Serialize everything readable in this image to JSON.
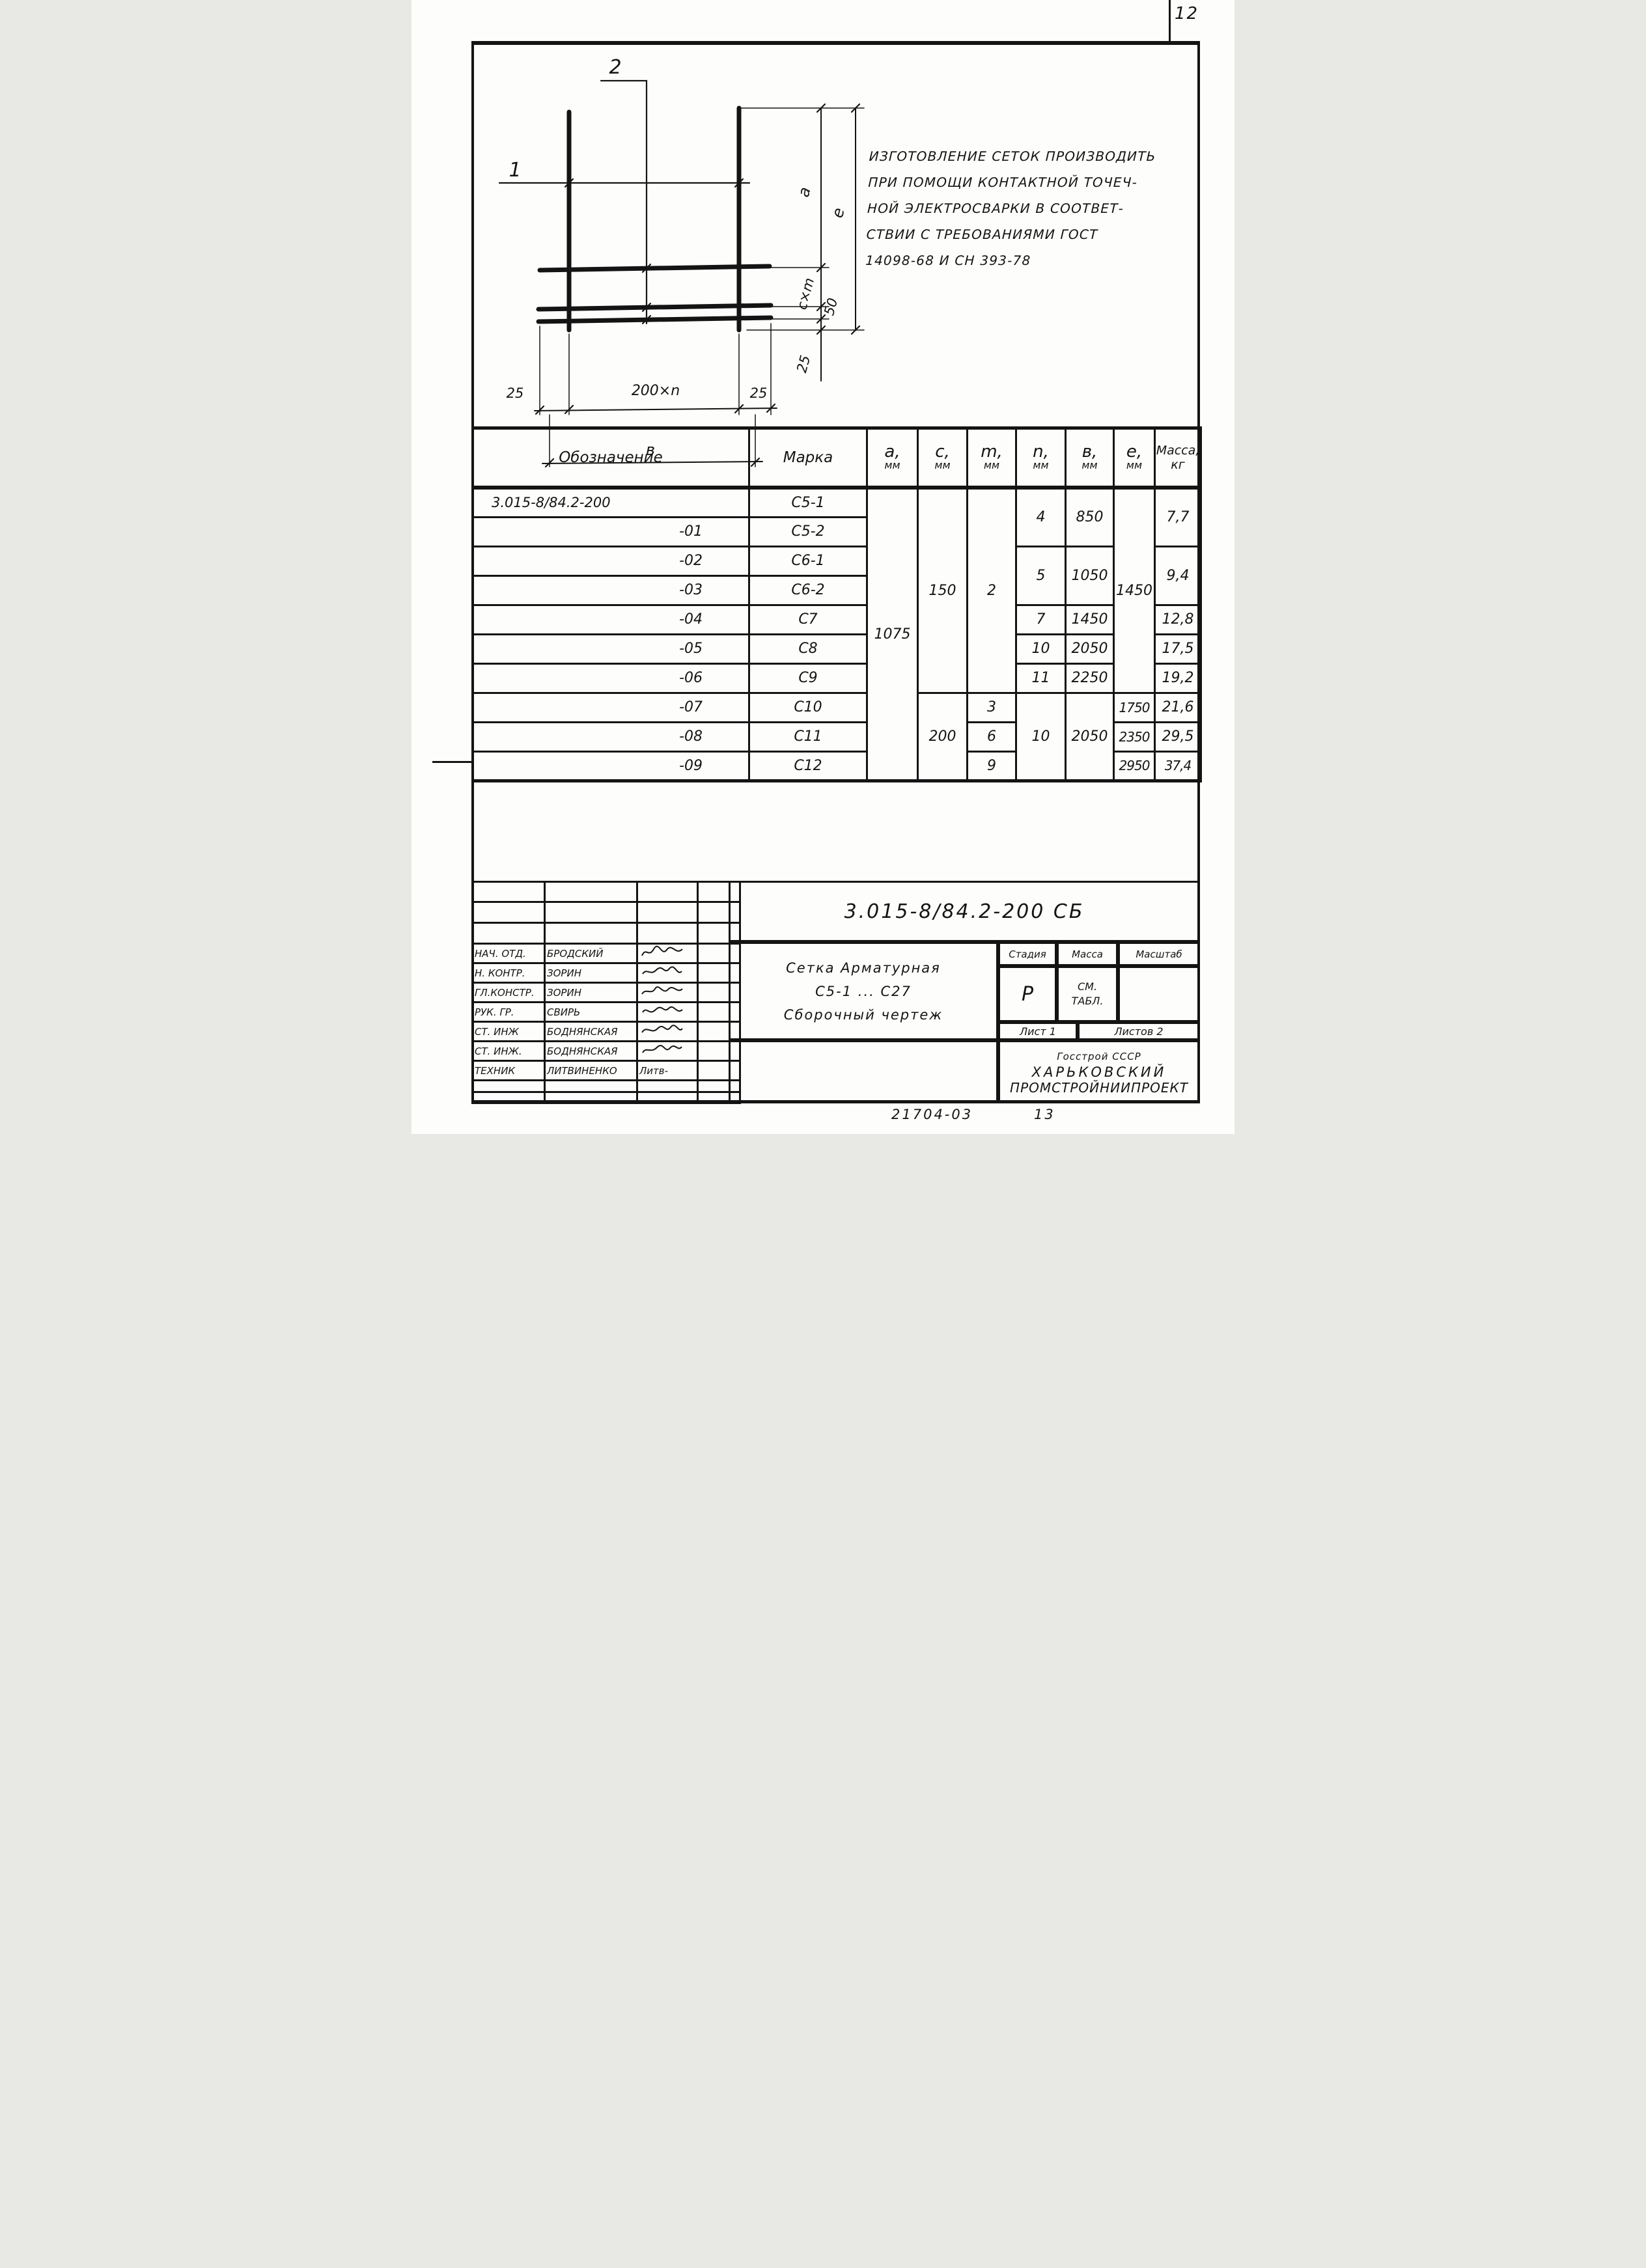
{
  "page": {
    "number": "12",
    "footer_left": "21704-03",
    "footer_right": "13"
  },
  "note": {
    "lines": [
      "ИЗГОТОВЛЕНИЕ СЕТОК ПРОИЗВОДИТЬ",
      "ПРИ ПОМОЩИ КОНТАКТНОЙ ТОЧЕЧ-",
      "НОЙ ЭЛЕКТРОСВАРКИ В СООТВЕТ-",
      "СТВИИ С ТРЕБОВАНИЯМИ ГОСТ",
      "14098-68 И СН 393-78"
    ]
  },
  "figure": {
    "callout_1": "1",
    "callout_2": "2",
    "dim_a": "a",
    "dim_e": "e",
    "dim_cxm": "c×m",
    "dim_50": "50",
    "dim_25_right": "25",
    "dim_25_left": "25",
    "dim_200xn": "200×n",
    "dim_25_bottom_right": "25",
    "dim_b": "в"
  },
  "table": {
    "headers": {
      "designation": "Обозначение",
      "mark": "Марка",
      "a": "a,",
      "c": "c,",
      "m": "m,",
      "n": "n,",
      "b": "в,",
      "e": "e,",
      "unit": "мм",
      "mass": "Масса,",
      "mass_unit": "кг"
    },
    "rows": [
      {
        "designation": "3.015-8/84.2-200",
        "mark": "С5-1",
        "a": "1075",
        "c": "150",
        "m": "2",
        "n": "4",
        "b": "850",
        "e": "1450",
        "mass": "7,7"
      },
      {
        "designation": "-01",
        "mark": "С5-2"
      },
      {
        "designation": "-02",
        "mark": "С6-1",
        "n": "5",
        "b": "1050",
        "mass": "9,4"
      },
      {
        "designation": "-03",
        "mark": "С6-2"
      },
      {
        "designation": "-04",
        "mark": "С7",
        "n": "7",
        "b": "1450",
        "mass": "12,8"
      },
      {
        "designation": "-05",
        "mark": "С8",
        "n": "10",
        "b": "2050",
        "mass": "17,5"
      },
      {
        "designation": "-06",
        "mark": "С9",
        "n": "11",
        "b": "2250",
        "mass": "19,2"
      },
      {
        "designation": "-07",
        "mark": "С10",
        "c": "200",
        "m": "3",
        "n": "10",
        "b": "2050",
        "e": "1750",
        "mass": "21,6"
      },
      {
        "designation": "-08",
        "mark": "С11",
        "m": "6",
        "e": "2350",
        "mass": "29,5"
      },
      {
        "designation": "-09",
        "mark": "С12",
        "m": "9",
        "e": "2950",
        "mass": "37,4"
      }
    ]
  },
  "title_block": {
    "doc_number": "3.015-8/84.2-200 СБ",
    "title_line1": "Сетка  Арматурная",
    "title_line2": "С5-1 ... С27",
    "title_line3": "Сборочный  чертеж",
    "stage_label": "Стадия",
    "mass_label": "Масса",
    "scale_label": "Масштаб",
    "stage_value": "Р",
    "mass_value_line1": "СМ.",
    "mass_value_line2": "ТАБЛ.",
    "sheet_label": "Лист 1",
    "sheets_label": "Листов 2",
    "org_line1": "Госстрой СССР",
    "org_line2": "ХАРЬКОВСКИЙ",
    "org_line3": "ПРОМСТРОЙНИИПРОЕКТ",
    "signers": [
      {
        "role": "НАЧ. ОТД.",
        "name": "БРОДСКИЙ",
        "sig": ""
      },
      {
        "role": "Н. КОНТР.",
        "name": "ЗОРИН",
        "sig": ""
      },
      {
        "role": "ГЛ.КОНСТР.",
        "name": "ЗОРИН",
        "sig": ""
      },
      {
        "role": "РУК. ГР.",
        "name": "СВИРЬ",
        "sig": ""
      },
      {
        "role": "СТ. ИНЖ",
        "name": "БОДНЯНСКАЯ",
        "sig": ""
      },
      {
        "role": "СТ. ИНЖ.",
        "name": "БОДНЯНСКАЯ",
        "sig": ""
      },
      {
        "role": "ТЕХНИК",
        "name": "ЛИТВИНЕНКО",
        "sig": "Литв-"
      }
    ]
  }
}
